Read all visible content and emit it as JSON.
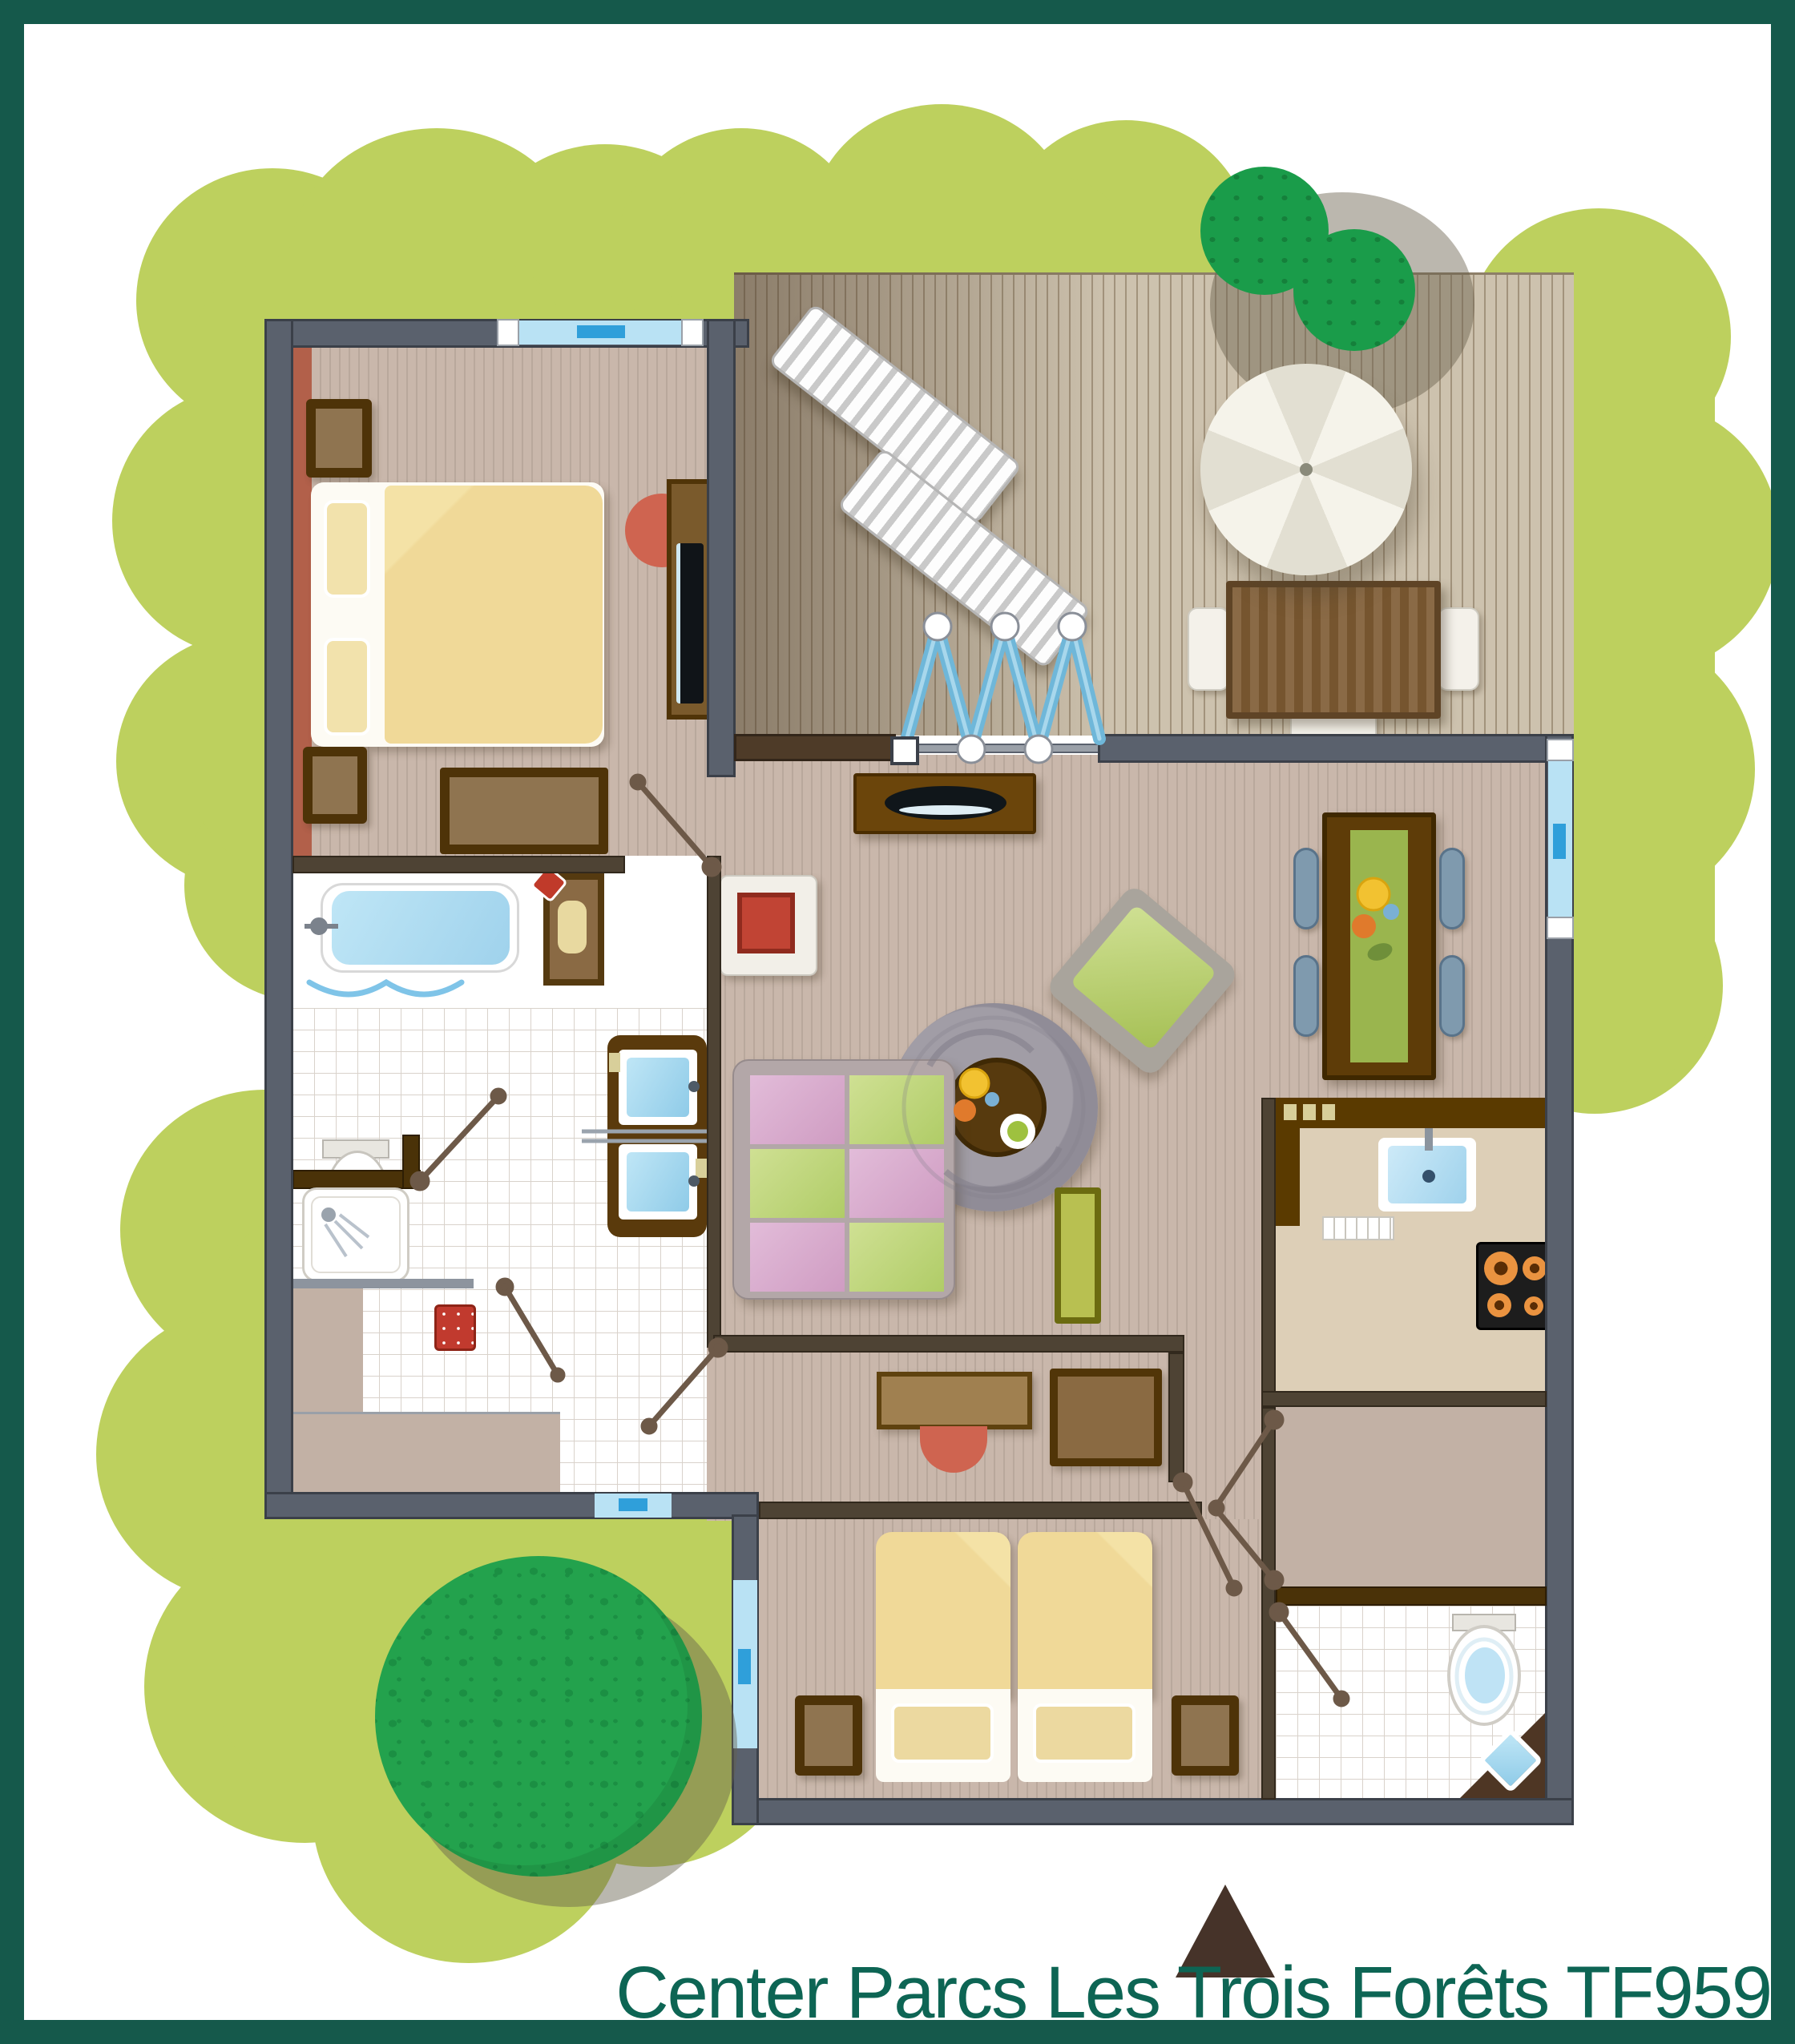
{
  "title": "Center Parcs Les Trois Forêts TF959",
  "brand": "Center Parcs",
  "park_name": "Les Trois Forêts",
  "cottage_code": "TF959",
  "colors": {
    "frame_teal": "#15594b",
    "title_teal": "#0d6554",
    "garden_green": "#bdd05e",
    "tree_green": "#23a24d",
    "deck_wood": "#cdc2ae",
    "floor_taupe": "#c9b7ab",
    "wall_gray": "#5a616d",
    "partition_brown": "#4e4334",
    "water_blue": "#a5d8f0",
    "window_blue": "#b9e2f4",
    "accent_red": "#c0432f",
    "duvet_yellow": "#f0d998",
    "cushion_pink": "#d7abcd",
    "cushion_green": "#bcd47b",
    "counter_beige": "#ddcfb7"
  },
  "rooms": [
    {
      "name": "bedroom-double"
    },
    {
      "name": "bathroom"
    },
    {
      "name": "living-room"
    },
    {
      "name": "dining-area"
    },
    {
      "name": "kitchen"
    },
    {
      "name": "hallway"
    },
    {
      "name": "bedroom-twin"
    },
    {
      "name": "wc"
    },
    {
      "name": "storage-closet"
    },
    {
      "name": "terrace"
    }
  ],
  "furniture": [
    {
      "name": "double-bed"
    },
    {
      "name": "nightstand",
      "count": 4
    },
    {
      "name": "wardrobe"
    },
    {
      "name": "tv-cabinet"
    },
    {
      "name": "red-chair",
      "count": 2
    },
    {
      "name": "bathtub"
    },
    {
      "name": "toilet",
      "count": 2
    },
    {
      "name": "shower"
    },
    {
      "name": "double-washbasin"
    },
    {
      "name": "laundry-box"
    },
    {
      "name": "fireplace-stove"
    },
    {
      "name": "sideboard"
    },
    {
      "name": "round-rug"
    },
    {
      "name": "coffee-table"
    },
    {
      "name": "armchair"
    },
    {
      "name": "sofa"
    },
    {
      "name": "side-table"
    },
    {
      "name": "dining-table"
    },
    {
      "name": "dining-chair",
      "count": 4
    },
    {
      "name": "kitchen-sink"
    },
    {
      "name": "dish-rack"
    },
    {
      "name": "cooktop"
    },
    {
      "name": "desk"
    },
    {
      "name": "dresser"
    },
    {
      "name": "twin-bed",
      "count": 2
    },
    {
      "name": "corner-washbasin"
    },
    {
      "name": "sun-lounger",
      "count": 2
    },
    {
      "name": "parasol"
    },
    {
      "name": "garden-table"
    },
    {
      "name": "garden-chair",
      "count": 3
    }
  ],
  "landscape": [
    {
      "name": "garden-bushes"
    },
    {
      "name": "large-tree"
    },
    {
      "name": "terrace-shrubs",
      "count": 2
    }
  ],
  "markers": [
    {
      "name": "north-arrow"
    },
    {
      "name": "accordion-terrace-door"
    },
    {
      "name": "door-swing",
      "count": 9
    },
    {
      "name": "window",
      "count": 4
    }
  ]
}
